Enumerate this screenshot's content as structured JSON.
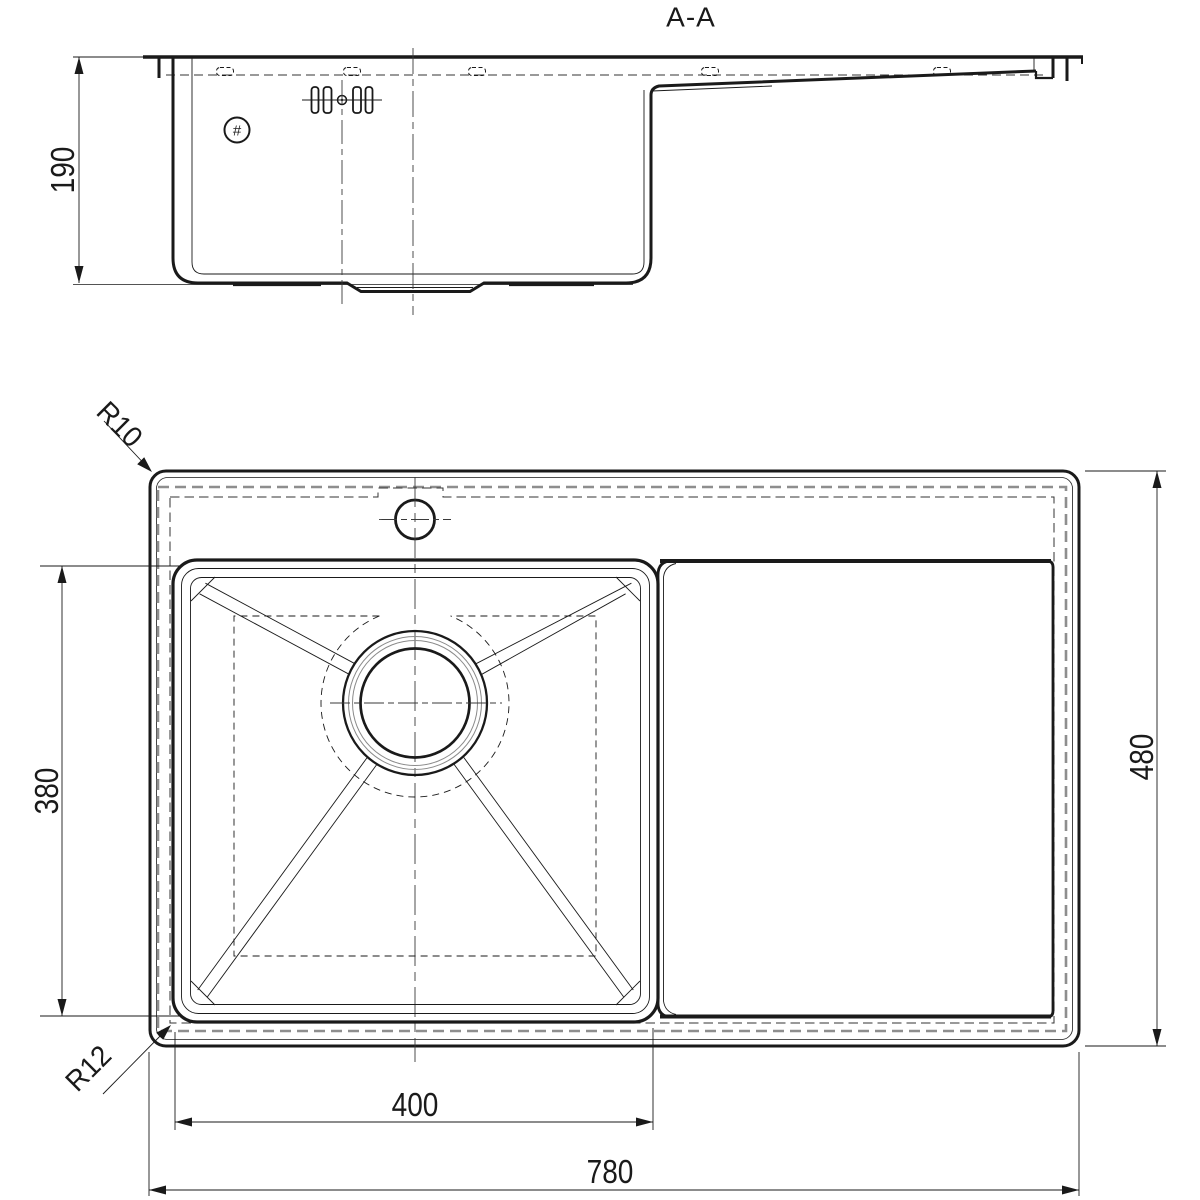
{
  "title": {
    "section_label": "A-A"
  },
  "section_view": {
    "depth_dim": "190",
    "hole_marker": "#"
  },
  "plan_view": {
    "bowl_length_dim": "400",
    "overall_length_dim": "780",
    "bowl_width_dim": "380",
    "overall_width_dim": "480",
    "outer_corner_radius": "R10",
    "bowl_corner_radius": "R12"
  },
  "colors": {
    "line": "#1a1a1a",
    "hidden_gray": "#8e8e8e"
  }
}
